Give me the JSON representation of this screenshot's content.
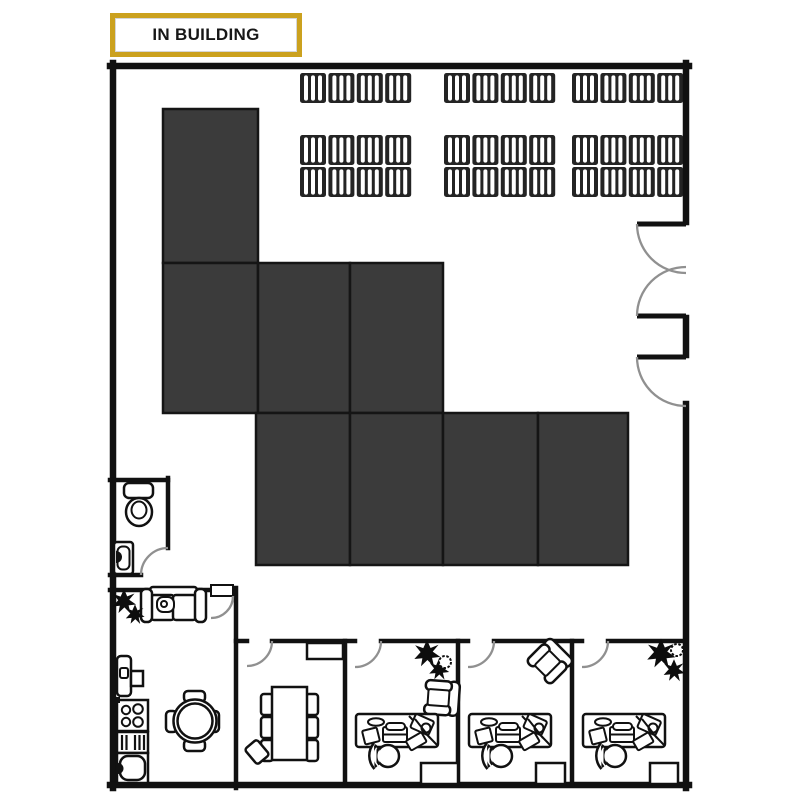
{
  "badge": {
    "label": "IN BUILDING",
    "border_color": "#CBA11E",
    "text_color": "#171717",
    "background": "#ffffff"
  },
  "colors": {
    "wall": "#111111",
    "storage_zone_fill": "#3B3B3B",
    "storage_zone_stroke": "#151515",
    "door_arc": "#909090",
    "background": "#ffffff"
  },
  "floorplan": {
    "storage_zones": [
      {
        "x": 163,
        "y": 109,
        "w": 95,
        "h": 154
      },
      {
        "x": 163,
        "y": 263,
        "w": 95,
        "h": 150
      },
      {
        "x": 258,
        "y": 263,
        "w": 92,
        "h": 150
      },
      {
        "x": 350,
        "y": 263,
        "w": 93,
        "h": 150
      },
      {
        "x": 256,
        "y": 413,
        "w": 94,
        "h": 152
      },
      {
        "x": 350,
        "y": 413,
        "w": 93,
        "h": 152
      },
      {
        "x": 443,
        "y": 413,
        "w": 95,
        "h": 152
      },
      {
        "x": 538,
        "y": 413,
        "w": 90,
        "h": 152
      }
    ],
    "pallet_racks": {
      "pallets_per_strip": 4,
      "pallet_width": 26,
      "pallet_height": 30,
      "gap": 2.4,
      "strips": [
        {
          "x": 300,
          "y": 73
        },
        {
          "x": 444,
          "y": 73
        },
        {
          "x": 572,
          "y": 73
        },
        {
          "x": 300,
          "y": 135
        },
        {
          "x": 444,
          "y": 135
        },
        {
          "x": 572,
          "y": 135
        },
        {
          "x": 300,
          "y": 167
        },
        {
          "x": 444,
          "y": 167
        },
        {
          "x": 572,
          "y": 167
        }
      ]
    }
  }
}
